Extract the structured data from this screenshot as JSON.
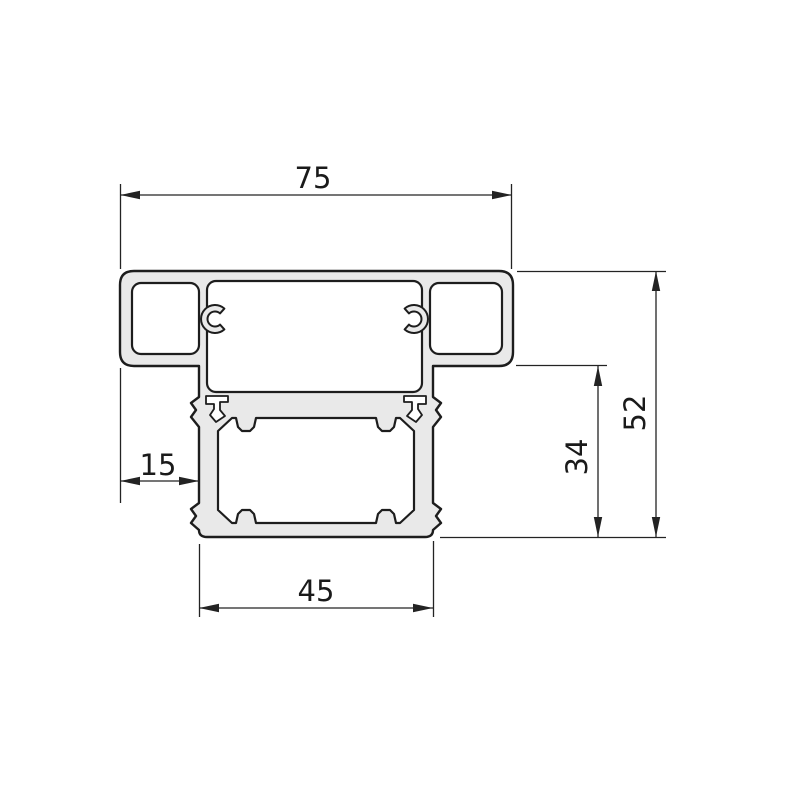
{
  "drawing": {
    "title": "Aluminium profile cross-section",
    "background_color": "#ffffff",
    "outline_color": "#1d1d1d",
    "material_fill_color": "#e9e9e9",
    "dimensions": {
      "top_width": "75",
      "overall_height": "52",
      "lower_section_height": "34",
      "left_flange_offset": "15",
      "bottom_width": "45"
    }
  }
}
